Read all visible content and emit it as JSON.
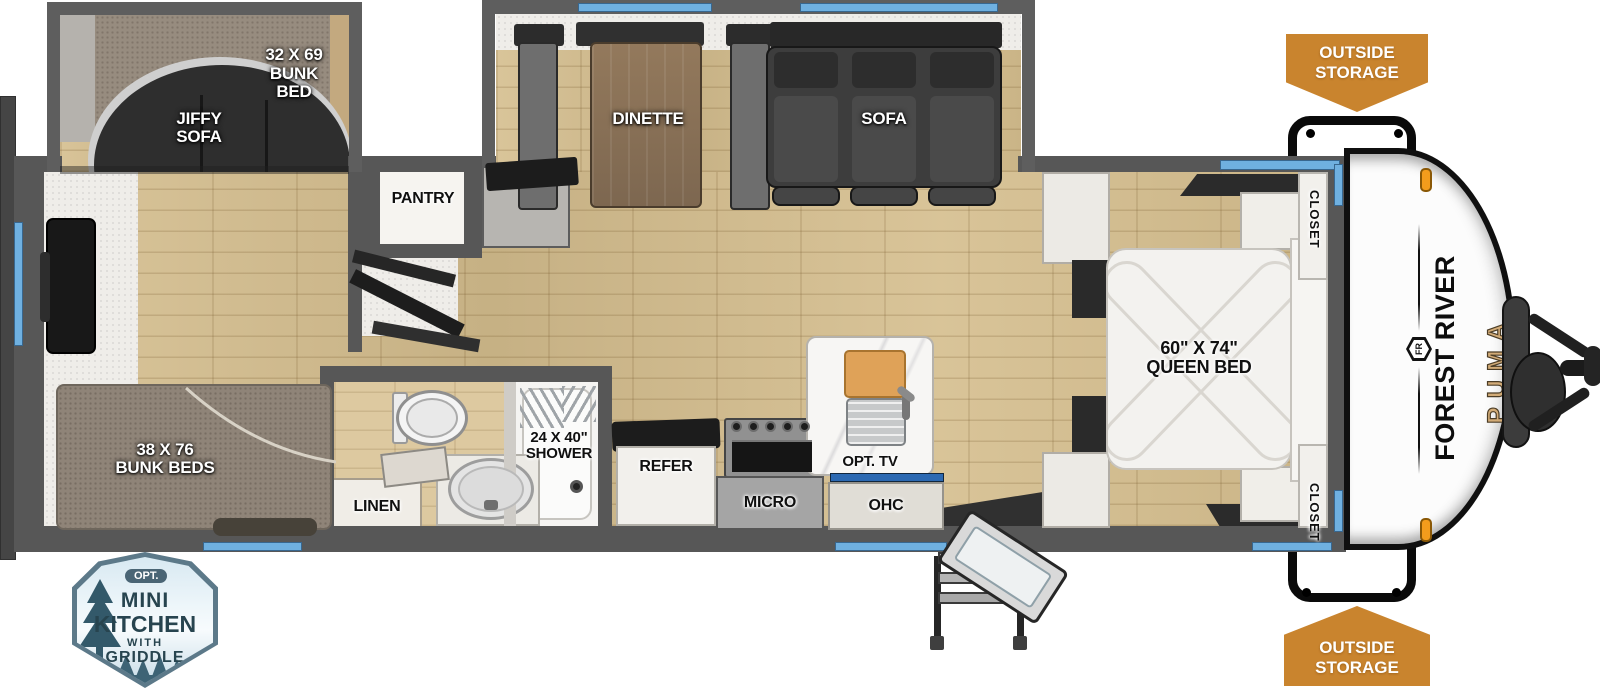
{
  "title": "Forest River Puma travel trailer floor plan",
  "colors": {
    "wall_gray": "#575757",
    "floor_wood": "#d5be8e",
    "window_blue": "#6fb0e0",
    "tv_blue": "#2c69b2",
    "banner_orange": "#c9842e",
    "badge_teal": "#446273",
    "puma_gold": "#d2ab77",
    "marker_light_orange": "#f39c1c"
  },
  "plan": {
    "slide_bunk": {
      "bunk_label": "32 X 69\nBUNK\nBED",
      "sofa_label": "JIFFY\nSOFA"
    },
    "living": {
      "dinette_label": "DINETTE",
      "sofa_label": "SOFA"
    },
    "rear": {
      "bunk_label": "38 X 76\nBUNK BEDS"
    },
    "pantry_label": "PANTRY",
    "bath": {
      "shower_label": "24 X 40\"\nSHOWER",
      "linen_label": "LINEN"
    },
    "kitchen": {
      "refer_label": "REFER",
      "micro_label": "MICRO",
      "ohc_label": "OHC",
      "tv_label": "OPT. TV"
    },
    "bedroom": {
      "bed_label": "60\" X 74\"\nQUEEN BED",
      "closet_top_label": "CLOSET",
      "closet_bottom_label": "CLOSET"
    }
  },
  "exterior": {
    "outside_storage_top": "OUTSIDE\nSTORAGE",
    "outside_storage_bottom": "OUTSIDE\nSTORAGE",
    "brand": "FOREST RIVER",
    "model": "PUMA",
    "monogram": "FR"
  },
  "badge": {
    "opt": "OPT.",
    "line_mini": "MINI",
    "line_kitchen": "KITCHEN",
    "line_with": "WITH",
    "line_griddle": "GRIDDLE"
  }
}
